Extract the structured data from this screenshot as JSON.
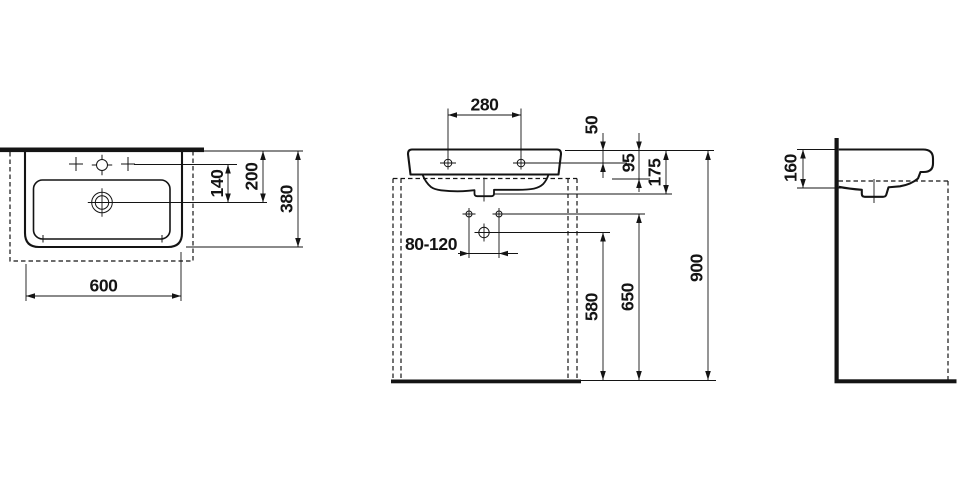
{
  "colors": {
    "line": "#141414",
    "background": "#ffffff"
  },
  "views": {
    "top": {
      "dims": {
        "tap_to_drain": "140",
        "wall_to_drain": "200",
        "depth": "380",
        "width": "600"
      }
    },
    "front": {
      "dims": {
        "tap_spacing": "280",
        "rim_to_fixing": "50",
        "rim_to_apron": "95",
        "basin_height": "175",
        "fixing_range": "80-120",
        "floor_to_siphon": "580",
        "floor_to_outlet": "650",
        "floor_to_rim": "900"
      }
    },
    "side": {
      "dims": {
        "rim_to_underside": "160"
      }
    }
  }
}
